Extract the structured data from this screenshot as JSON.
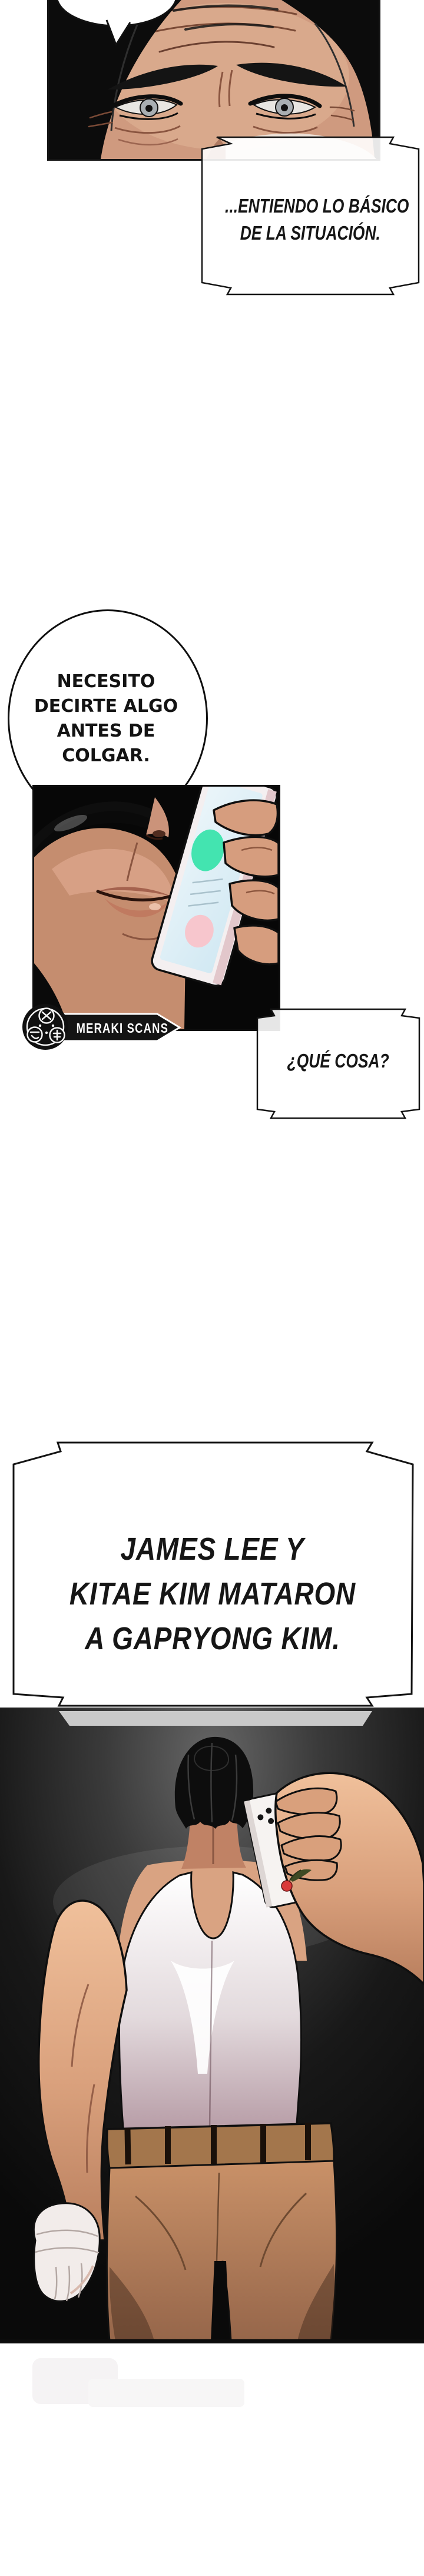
{
  "comic": {
    "caption_intro": {
      "lines": [
        "...ENTIENDO LO BÁSICO",
        "DE LA SITUACIÓN."
      ]
    },
    "speech_bubble": {
      "lines": [
        "NECESITO",
        "DECIRTE ALGO",
        "ANTES DE",
        "COLGAR."
      ]
    },
    "credit_badge": {
      "label": "MERAKI SCANS"
    },
    "caption_question": {
      "text": "¿QUÉ COSA?"
    },
    "caption_reveal": {
      "lines": [
        "JAMES LEE Y",
        "KITAE KIM MATARON",
        "A GAPRYONG KIM."
      ]
    }
  },
  "colors": {
    "ink": "#111111",
    "paper": "#ffffff",
    "panel_black": "#070707",
    "skin_highlight": "#f0c09b",
    "skin_mid": "#d9a07c",
    "skin_shadow": "#b97f5e",
    "hair_black": "#0d0d0d",
    "tank_shadow_mauve": "#b59aa4",
    "pants_tan": "#c08a5f",
    "belt_khaki": "#a3764c",
    "phone_screen_blue": "#d6ecf4",
    "call_green": "#43e4b0",
    "call_pink": "#f7c6cd",
    "band_gray": "#c9c9c9"
  }
}
